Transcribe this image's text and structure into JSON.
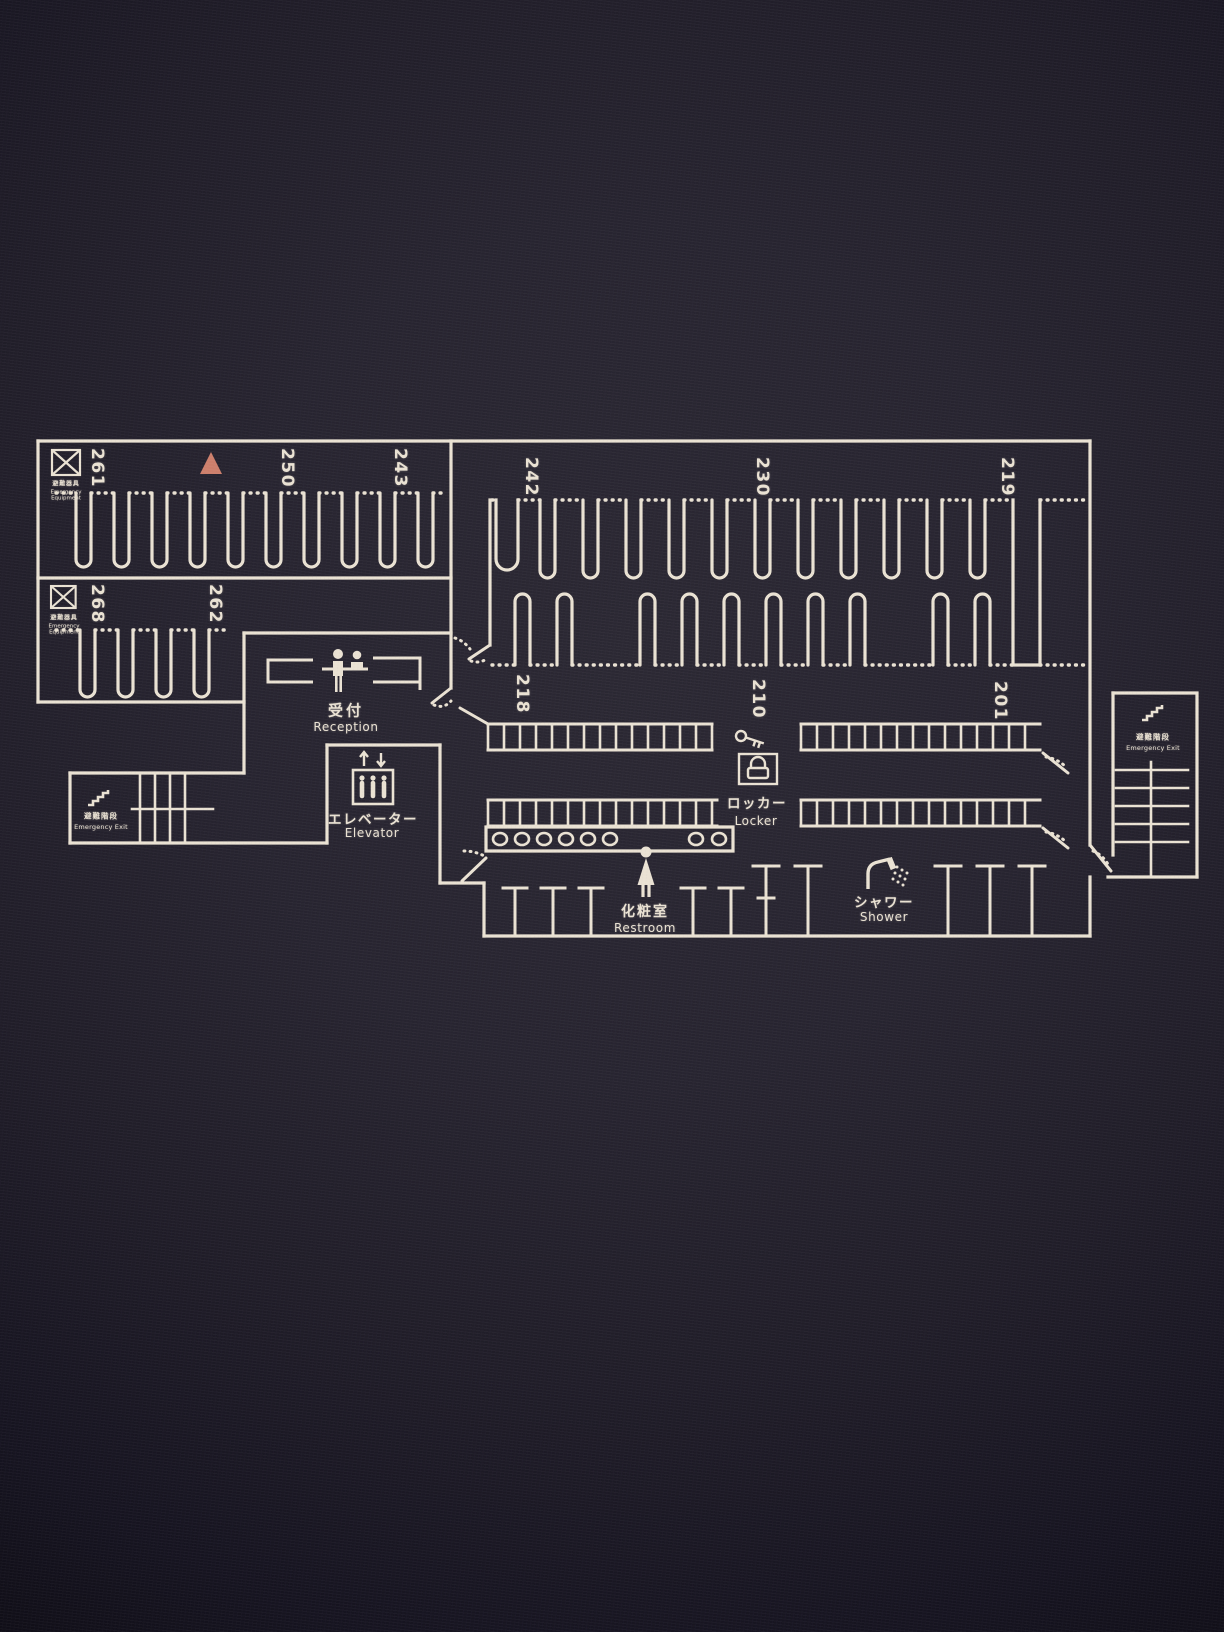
{
  "floor_map": {
    "capsule_numbers": {
      "left_row1": [
        "261",
        "250",
        "243"
      ],
      "left_row2": [
        "268",
        "262"
      ],
      "right_row1": [
        "242",
        "230",
        "219"
      ],
      "right_row2": [
        "218",
        "210",
        "201"
      ]
    },
    "labels": {
      "reception": {
        "jp": "受付",
        "en": "Reception"
      },
      "elevator": {
        "jp": "エレベーター",
        "en": "Elevator"
      },
      "locker": {
        "jp": "ロッカー",
        "en": "Locker"
      },
      "restroom": {
        "jp": "化粧室",
        "en": "Restroom"
      },
      "shower": {
        "jp": "シャワー",
        "en": "Shower"
      }
    },
    "emergency": {
      "exit": {
        "jp": "避難階段",
        "en": "Emergency Exit"
      },
      "equipment": {
        "jp": "避難器具",
        "en": "Emergency Equipment"
      }
    },
    "colors": {
      "line": "#eae2d3",
      "background": "#242130",
      "you_are_here": "#cd7f6b"
    }
  }
}
